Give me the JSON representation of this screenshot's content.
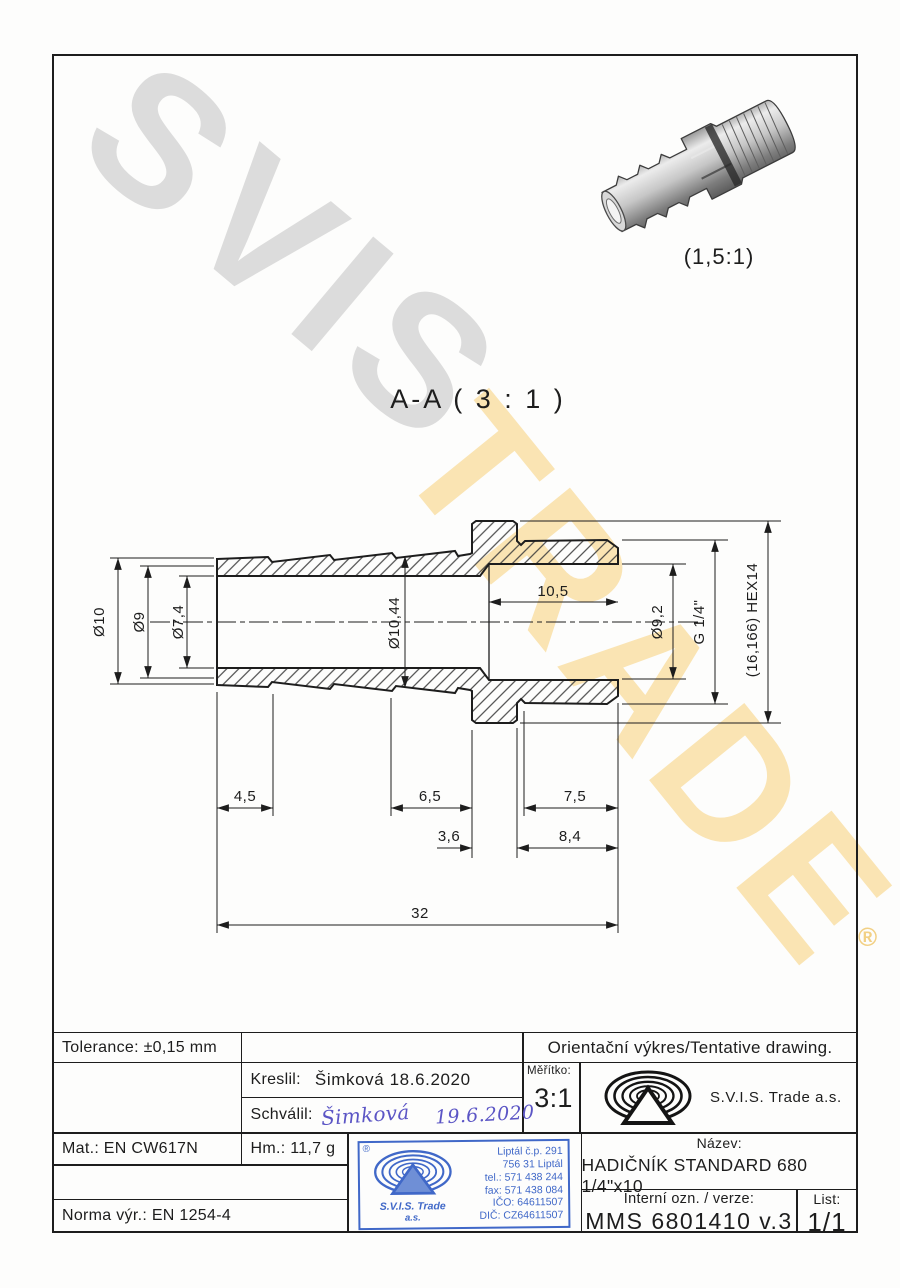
{
  "watermarks": {
    "grey": "SVIS",
    "yellow": "TRADE",
    "registered": "®"
  },
  "pictorial": {
    "scale_label": "(1,5:1)"
  },
  "section": {
    "title": "A-A ( 3 : 1 )",
    "dims": {
      "d10": "Ø10",
      "d9": "Ø9",
      "d74": "Ø7,4",
      "d1044": "Ø10,44",
      "len105": "10,5",
      "d92": "Ø9,2",
      "g14": "G 1/4\"",
      "hex": "(16,166) HEX14",
      "len45": "4,5",
      "len65": "6,5",
      "len75": "7,5",
      "len36": "3,6",
      "len84": "8,4",
      "len32": "32"
    }
  },
  "titleblock": {
    "tolerance": "Tolerance: ±0,15 mm",
    "orientacni": "Orientační výkres/Tentative drawing.",
    "kreslil_label": "Kreslil:",
    "kreslil_value": "Šimková 18.6.2020",
    "schvalil_label": "Schválil:",
    "schvalil_sig": "Šimková",
    "schvalil_date": "19.6.2020",
    "meritko_label": "Měřítko:",
    "meritko_value": "3:1",
    "company": "S.V.I.S. Trade a.s.",
    "mat": "Mat.: EN CW617N",
    "hm": "Hm.: 11,7 g",
    "norma": "Norma výr.: EN 1254-4",
    "nazev_label": "Název:",
    "nazev_value": "HADIČNÍK STANDARD 680 1/4\"x10",
    "interni_label": "Interní ozn. / verze:",
    "interni_value": "MMS 6801410 v.3",
    "list_label": "List:",
    "list_value": "1/1"
  },
  "stamp": {
    "registered": "®",
    "company": "S.V.I.S. Trade",
    "suffix": "a.s.",
    "lines": [
      "Liptál č.p. 291",
      "756 31 Liptál",
      "tel.: 571 438 244",
      "fax: 571 438 084",
      "IČO: 64611507",
      "DIČ: CZ64611507"
    ]
  }
}
